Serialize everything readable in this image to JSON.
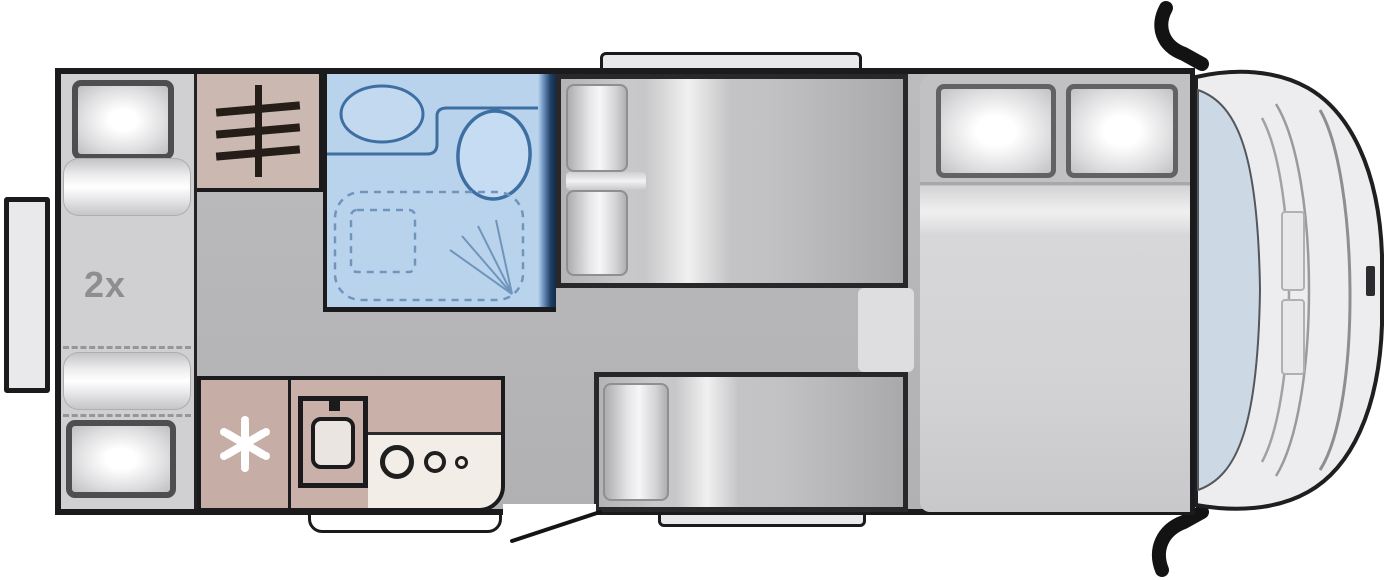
{
  "meta": {
    "type": "motorhome-floorplan-top-view",
    "orientation": "cab-on-right"
  },
  "labels": {
    "berth_count": "2x"
  },
  "areas": [
    {
      "id": "rear-lounge",
      "name": "Rear lounge / twin beds",
      "pillows": 2,
      "cushions": 2
    },
    {
      "id": "wardrobe",
      "name": "Wardrobe with hanger rail"
    },
    {
      "id": "bathroom",
      "name": "Bathroom",
      "fixtures": [
        "washbasin",
        "toilet",
        "shower"
      ]
    },
    {
      "id": "kitchen",
      "name": "Kitchen",
      "fixtures": [
        "fridge",
        "sink",
        "hob"
      ],
      "hob_burners": 3
    },
    {
      "id": "dinette",
      "name": "Dinette seating group",
      "cushions": 2
    },
    {
      "id": "side-bench",
      "name": "Side bench seat",
      "cushions": 1
    },
    {
      "id": "double-bed",
      "name": "Double bed",
      "pillows": 2
    },
    {
      "id": "cab",
      "name": "Driver cab",
      "mirrors": 2
    }
  ],
  "openings": {
    "windows": 3,
    "entry_door": 1,
    "entry_step": 1,
    "bathroom_sliding_door": 1
  },
  "icons": [
    "hanger-rail-icon",
    "snowflake-icon",
    "shower-spray-icon"
  ],
  "colors": {
    "wall": "#1b1b1d",
    "floor": "#b6b6b8",
    "rear_platform": "#d0d0d2",
    "bathroom_fill": "#bad3ec",
    "bathroom_line": "#3e6fa2",
    "bathroom_door": "#1f4066",
    "wardrobe_fill": "#cbb9b1",
    "fridge_fill": "#c6ada5",
    "counter_fill": "#c9b1a9",
    "hob_fill": "#f3ede7",
    "bed_fill": "#d4d4d6",
    "cushion_highlight": "#f6f6f8",
    "windshield": "#ccd8e4",
    "mirror": "#131313",
    "label_text": "#8e8e90"
  }
}
